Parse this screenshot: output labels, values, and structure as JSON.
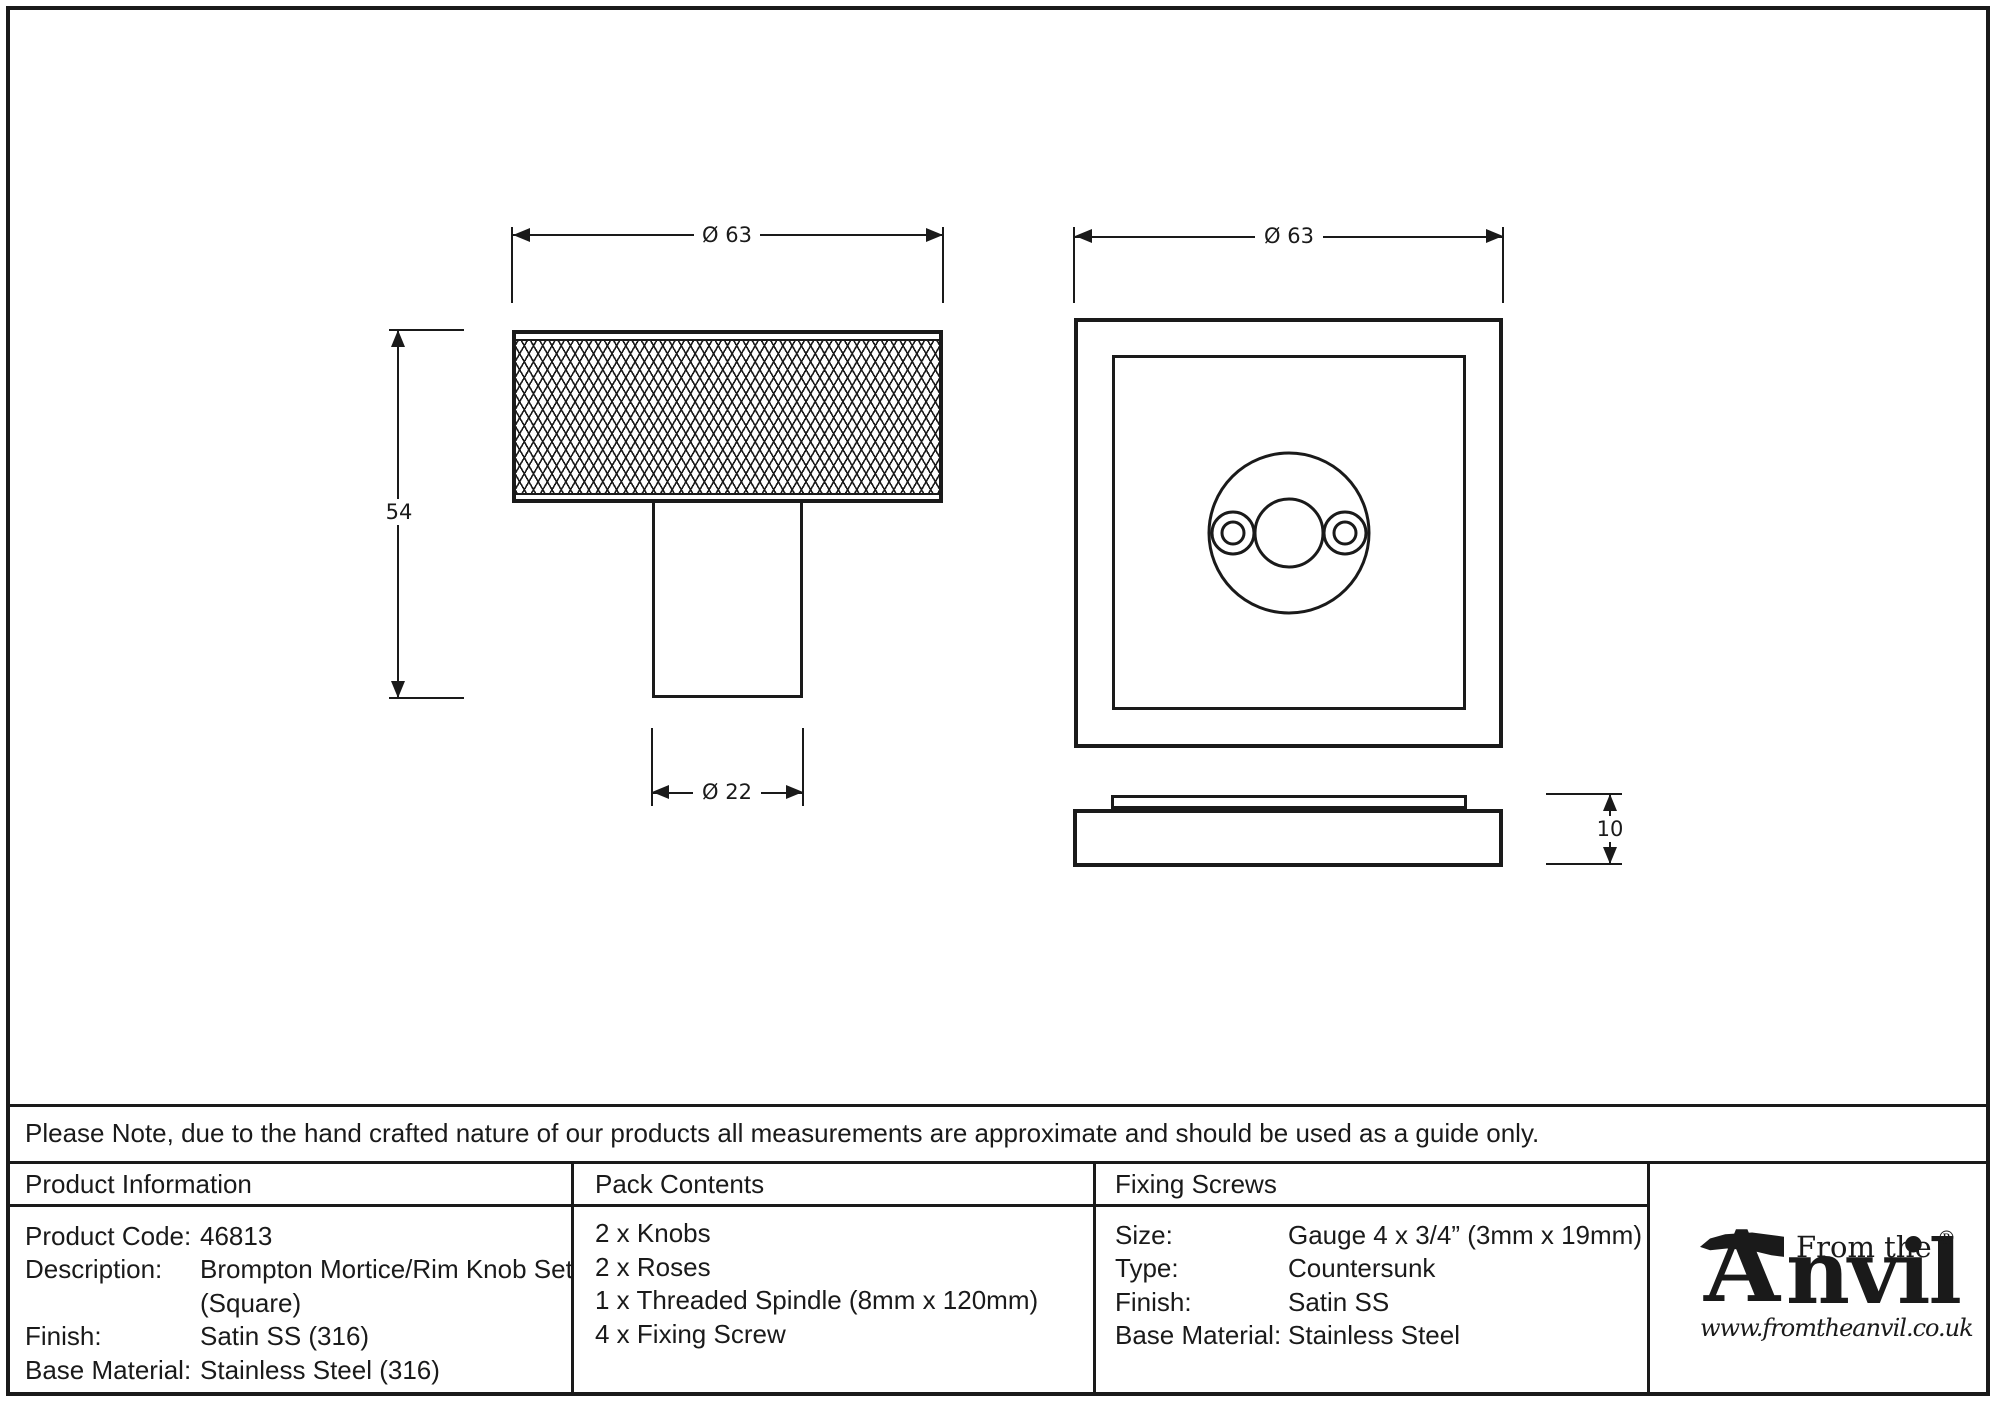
{
  "note": "Please Note, due to the hand crafted nature of our products all measurements are approximate and should be used as a guide only.",
  "drawings": {
    "knob_front": {
      "dim_width": "Ø 63",
      "dim_height": "54",
      "dim_stem": "Ø 22"
    },
    "rose_front": {
      "dim_width": "Ø 63"
    },
    "rose_side": {
      "dim_thickness": "10"
    }
  },
  "table": {
    "product_information": {
      "header": "Product Information",
      "rows": [
        {
          "label": "Product Code:",
          "value": "46813"
        },
        {
          "label": "Description:",
          "value": "Brompton Mortice/Rim Knob Set"
        },
        {
          "label": "",
          "value": "(Square)"
        },
        {
          "label": "Finish:",
          "value": "Satin SS (316)"
        },
        {
          "label": "Base Material:",
          "value": "Stainless Steel (316)"
        }
      ]
    },
    "pack_contents": {
      "header": "Pack Contents",
      "items": [
        "2 x Knobs",
        "2 x Roses",
        "1 x Threaded Spindle (8mm x 120mm)",
        "4 x Fixing Screw"
      ]
    },
    "fixing_screws": {
      "header": "Fixing Screws",
      "rows": [
        {
          "label": "Size:",
          "value": "Gauge 4 x 3/4” (3mm x 19mm)"
        },
        {
          "label": "Type:",
          "value": "Countersunk"
        },
        {
          "label": "Finish:",
          "value": "Satin SS"
        },
        {
          "label": "Base Material:",
          "value": "Stainless Steel"
        }
      ]
    }
  },
  "logo": {
    "brand_prefix": "From the",
    "brand_initial": "A",
    "brand_rest": "nvil",
    "registered": "®",
    "diamond": "♦",
    "website": "www.fromtheanvil.co.uk"
  },
  "colors": {
    "ink": "#1a1a1a",
    "background": "#ffffff"
  }
}
